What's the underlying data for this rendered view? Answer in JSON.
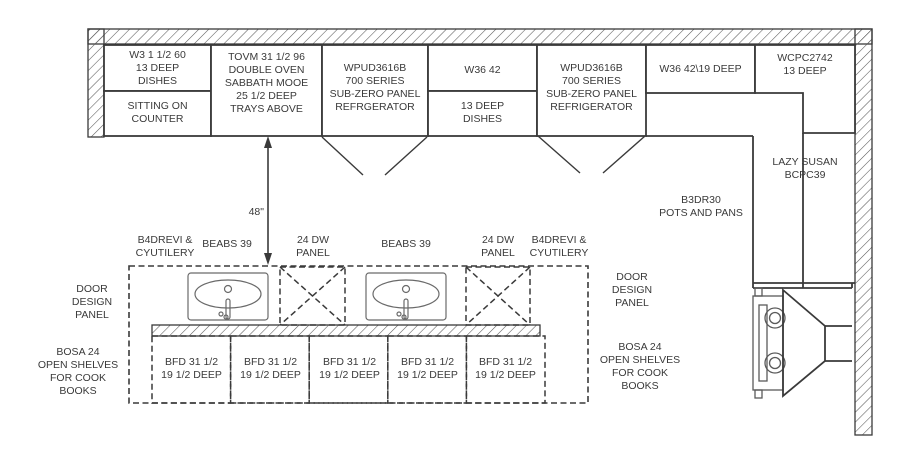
{
  "colors": {
    "line": "#3a3a3a",
    "text": "#3a3a3a",
    "background": "#ffffff"
  },
  "upper_run": {
    "cab1": {
      "top": "W3 1 1/2 60\n13 DEEP\nDISHES",
      "bottom": "SITTING ON\nCOUNTER"
    },
    "cab2": "TOVM 31 1/2 96\nDOUBLE OVEN\nSABBATH MOOE\n25 1/2 DEEP\nTRAYS ABOVE",
    "cab3": "WPUD3616B\n700 SERIES\nSUB-ZERO PANEL\nREFRGERATOR",
    "cab4": {
      "top": "W36 42",
      "bottom": "13 DEEP\nDISHES"
    },
    "cab5": "WPUD3616B\n700 SERIES\nSUB-ZERO PANEL\nREFRIGERATOR",
    "cab6": "W36 42\\19 DEEP",
    "cab7": "WCPC2742\n13 DEEP"
  },
  "right_run": {
    "lazy_susan": "LAZY SUSAN\nBCPC39",
    "pots_pans": "B3DR30\nPOTS AND PANS"
  },
  "dimension": {
    "label": "48\""
  },
  "island": {
    "left_upper": "B4DREVI &\nCYUTILERY",
    "sink_left_label": "BEABS 39",
    "dw_left": "24 DW\nPANEL",
    "sink_right_label": "BEABS 39",
    "dw_right": "24 DW\nPANEL",
    "right_upper": "B4DREVI &\nCYUTILERY",
    "door_panel_left": "DOOR\nDESIGN\nPANEL",
    "door_panel_right": "DOOR\nDESIGN\nPANEL",
    "shelves_left": "BOSA 24\nOPEN SHELVES\nFOR COOK\nBOOKS",
    "shelves_right": "BOSA 24\nOPEN SHELVES\nFOR COOK\nBOOKS",
    "base_units": [
      {
        "label": "BFD 31 1/2\n19 1/2 DEEP"
      },
      {
        "label": "BFD 31 1/2\n19 1/2 DEEP"
      },
      {
        "label": "BFD 31 1/2\n19 1/2 DEEP"
      },
      {
        "label": "BFD 31 1/2\n19 1/2 DEEP"
      },
      {
        "label": "BFD 31 1/2\n19 1/2 DEEP"
      }
    ]
  }
}
